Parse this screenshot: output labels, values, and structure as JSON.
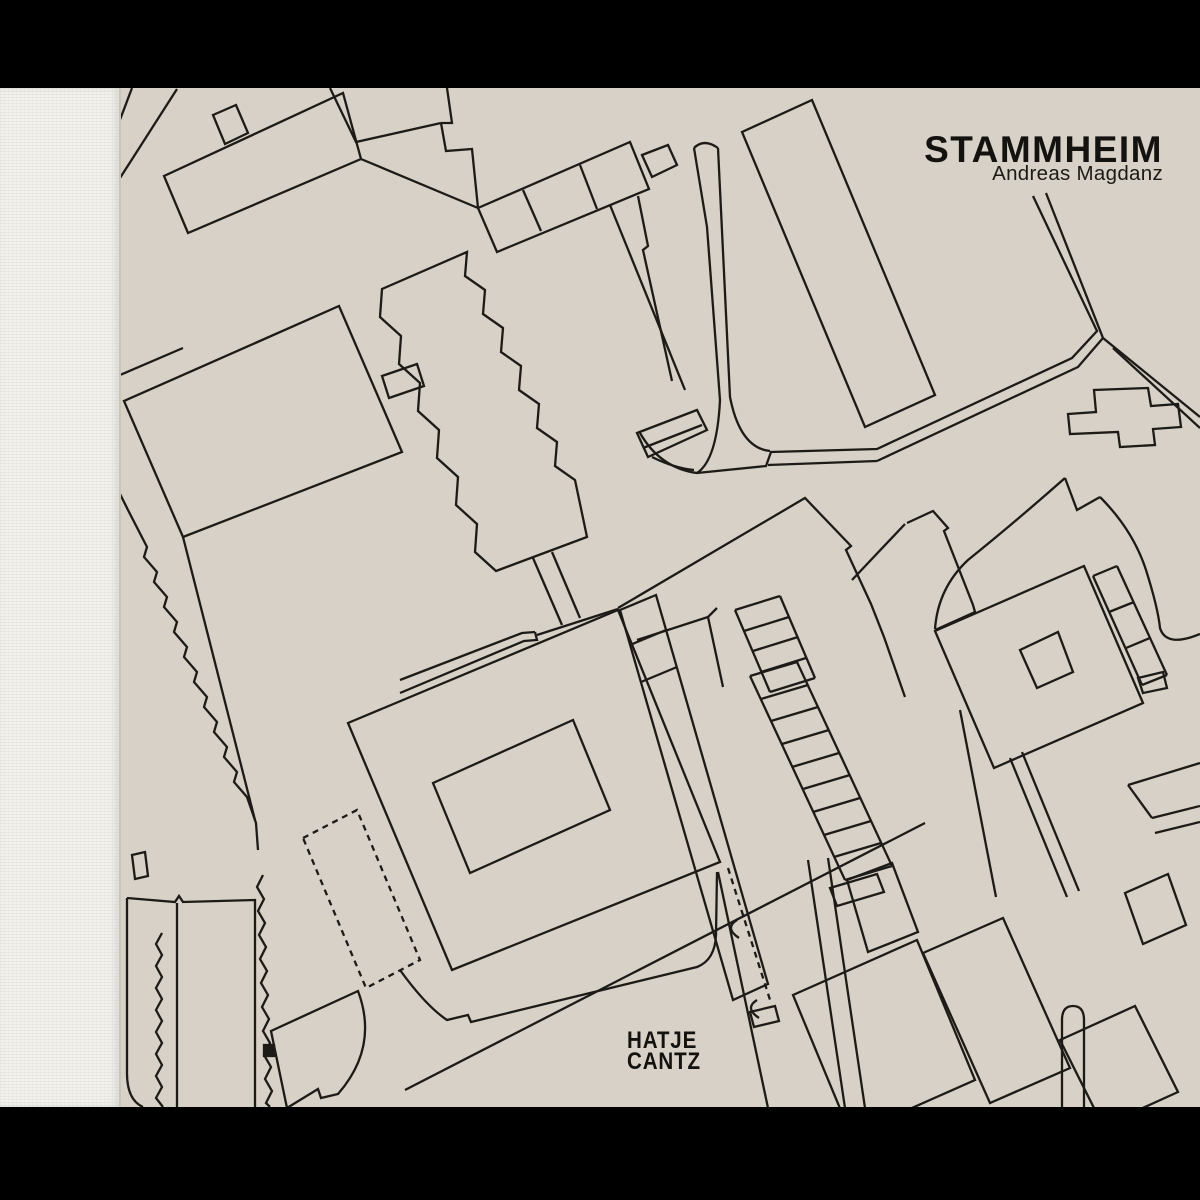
{
  "cover": {
    "title": "STAMMHEIM",
    "author": "Andreas Magdanz",
    "publisher": {
      "line1": "HATJE",
      "line2": "CANTZ"
    },
    "artwork": "architectural-site-plan-line-drawing",
    "colors": {
      "cover_background": "#d7d1c7",
      "plan_line": "#1d1b18",
      "spine": "#f2f1ec",
      "frame_bars": "#000000",
      "text": "#14120f"
    }
  }
}
